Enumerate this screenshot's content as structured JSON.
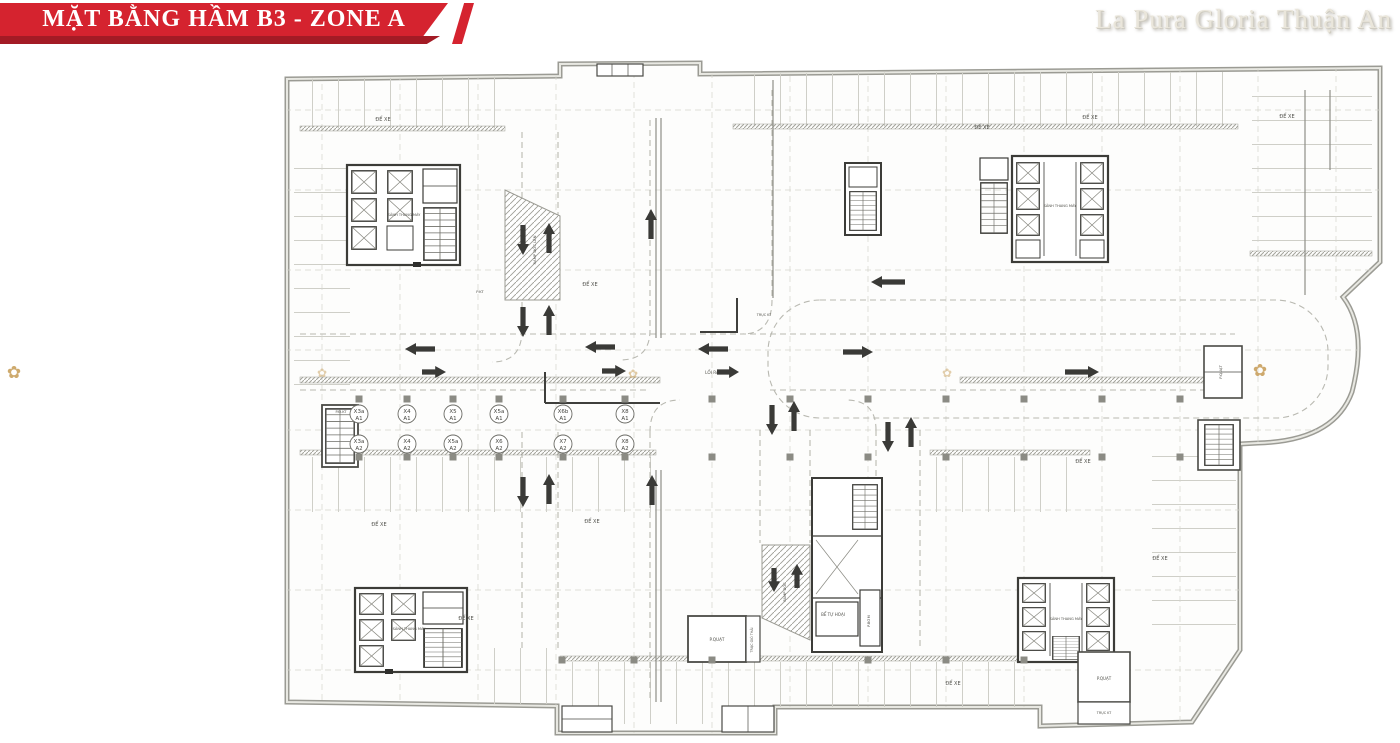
{
  "header": {
    "banner_title": "MẶT BẰNG HẦM B3 - ZONE A",
    "brand": "La Pura Gloria Thuận An",
    "colors": {
      "banner_red": "#d5232f",
      "banner_shadow_red": "#a31b25",
      "brand_text": "#eae6db",
      "emblem_gold": "#c9a15e"
    }
  },
  "plan": {
    "labels": [
      {
        "text": "ĐỂ XE",
        "x": 383,
        "y": 121,
        "s": 5
      },
      {
        "text": "ĐỂ XE",
        "x": 590,
        "y": 286,
        "s": 5
      },
      {
        "text": "ĐỂ XE",
        "x": 982,
        "y": 129,
        "s": 5
      },
      {
        "text": "ĐỂ XE",
        "x": 1090,
        "y": 119,
        "s": 5
      },
      {
        "text": "ĐỂ XE",
        "x": 1287,
        "y": 118,
        "s": 5
      },
      {
        "text": "ĐỂ XE",
        "x": 379,
        "y": 526,
        "s": 5
      },
      {
        "text": "ĐỂ XE",
        "x": 592,
        "y": 523,
        "s": 5
      },
      {
        "text": "ĐỂ XE",
        "x": 466,
        "y": 620,
        "s": 5
      },
      {
        "text": "ĐỂ XE",
        "x": 1083,
        "y": 463,
        "s": 5
      },
      {
        "text": "ĐỂ XE",
        "x": 1160,
        "y": 560,
        "s": 5
      },
      {
        "text": "ĐỂ XE",
        "x": 953,
        "y": 685,
        "s": 5
      },
      {
        "text": "SẢNH THANG MÁY",
        "x": 404,
        "y": 216,
        "s": 3.6
      },
      {
        "text": "SẢNH THANG MÁY",
        "x": 1060,
        "y": 207,
        "s": 3.6
      },
      {
        "text": "SẢNH THANG MÁY",
        "x": 409,
        "y": 630,
        "s": 3.6
      },
      {
        "text": "SẢNH THANG MÁY",
        "x": 1066,
        "y": 620,
        "s": 3.6
      },
      {
        "text": "P.QUẠT",
        "x": 717,
        "y": 641,
        "s": 4.2
      },
      {
        "text": "P.QUẠT",
        "x": 1222,
        "y": 372,
        "s": 3.8,
        "rot": -90
      },
      {
        "text": "P.QUẠT",
        "x": 1104,
        "y": 680,
        "s": 4
      },
      {
        "text": "TRỤC GIÓ THẢI",
        "x": 753,
        "y": 640,
        "s": 3.3,
        "rot": -90
      },
      {
        "text": "BỂ TỰ HOẠI",
        "x": 833,
        "y": 616,
        "s": 4
      },
      {
        "text": "P.BƠM",
        "x": 870,
        "y": 621,
        "s": 3.6,
        "rot": -90
      },
      {
        "text": "TRỤC KT",
        "x": 1104,
        "y": 714,
        "s": 3.4
      },
      {
        "text": "P.Đ.KT",
        "x": 341,
        "y": 413,
        "s": 3.6
      },
      {
        "text": "RAMP DỐC LÊN",
        "x": 536,
        "y": 250,
        "s": 3.8,
        "rot": -90
      },
      {
        "text": "RAMP DỐC",
        "x": 786,
        "y": 592,
        "s": 3.6,
        "rot": -90
      },
      {
        "text": "LỐI RA",
        "x": 712,
        "y": 374,
        "s": 4.2
      },
      {
        "text": "TRỤC KT",
        "x": 764,
        "y": 316,
        "s": 3.4
      },
      {
        "text": "P.KT",
        "x": 480,
        "y": 293,
        "s": 3.8
      }
    ],
    "grid_bubbles": [
      {
        "t": "X3a",
        "b": "A1",
        "x": 359,
        "y": 414
      },
      {
        "t": "X4",
        "b": "A1",
        "x": 407,
        "y": 414
      },
      {
        "t": "X5",
        "b": "A1",
        "x": 453,
        "y": 414
      },
      {
        "t": "X5a",
        "b": "A1",
        "x": 499,
        "y": 414
      },
      {
        "t": "X6b",
        "b": "A1",
        "x": 563,
        "y": 414
      },
      {
        "t": "X8",
        "b": "A1",
        "x": 625,
        "y": 414
      },
      {
        "t": "X3a",
        "b": "A2",
        "x": 359,
        "y": 444
      },
      {
        "t": "X4",
        "b": "A2",
        "x": 407,
        "y": 444
      },
      {
        "t": "X5a",
        "b": "A2",
        "x": 453,
        "y": 444
      },
      {
        "t": "X6",
        "b": "A2",
        "x": 499,
        "y": 444
      },
      {
        "t": "X7",
        "b": "A2",
        "x": 563,
        "y": 444
      },
      {
        "t": "X8",
        "b": "A2",
        "x": 625,
        "y": 444
      }
    ],
    "flow_arrows": [
      {
        "x": 523,
        "y": 240,
        "dir": "down"
      },
      {
        "x": 549,
        "y": 238,
        "dir": "up"
      },
      {
        "x": 523,
        "y": 322,
        "dir": "down"
      },
      {
        "x": 549,
        "y": 320,
        "dir": "up"
      },
      {
        "x": 651,
        "y": 224,
        "dir": "up"
      },
      {
        "x": 420,
        "y": 349,
        "dir": "left"
      },
      {
        "x": 434,
        "y": 372,
        "dir": "right",
        "len": 24
      },
      {
        "x": 600,
        "y": 347,
        "dir": "left"
      },
      {
        "x": 614,
        "y": 371,
        "dir": "right",
        "len": 24
      },
      {
        "x": 713,
        "y": 349,
        "dir": "left"
      },
      {
        "x": 728,
        "y": 372,
        "dir": "right",
        "len": 22
      },
      {
        "x": 858,
        "y": 352,
        "dir": "right"
      },
      {
        "x": 888,
        "y": 282,
        "dir": "left",
        "len": 34
      },
      {
        "x": 1082,
        "y": 372,
        "dir": "right",
        "len": 34
      },
      {
        "x": 772,
        "y": 420,
        "dir": "down"
      },
      {
        "x": 794,
        "y": 416,
        "dir": "up"
      },
      {
        "x": 888,
        "y": 437,
        "dir": "down"
      },
      {
        "x": 911,
        "y": 432,
        "dir": "up"
      },
      {
        "x": 523,
        "y": 492,
        "dir": "down"
      },
      {
        "x": 549,
        "y": 489,
        "dir": "up"
      },
      {
        "x": 652,
        "y": 490,
        "dir": "up"
      },
      {
        "x": 774,
        "y": 580,
        "dir": "down",
        "len": 24
      },
      {
        "x": 797,
        "y": 576,
        "dir": "up",
        "len": 24
      }
    ],
    "emblems": [
      {
        "x": 14,
        "y": 378,
        "s": 17,
        "o": 0.9
      },
      {
        "x": 1260,
        "y": 376,
        "s": 17,
        "o": 0.9
      },
      {
        "x": 322,
        "y": 377,
        "s": 12,
        "o": 0.5
      },
      {
        "x": 633,
        "y": 378,
        "s": 12,
        "o": 0.55
      },
      {
        "x": 947,
        "y": 377,
        "s": 12,
        "o": 0.5
      }
    ]
  }
}
